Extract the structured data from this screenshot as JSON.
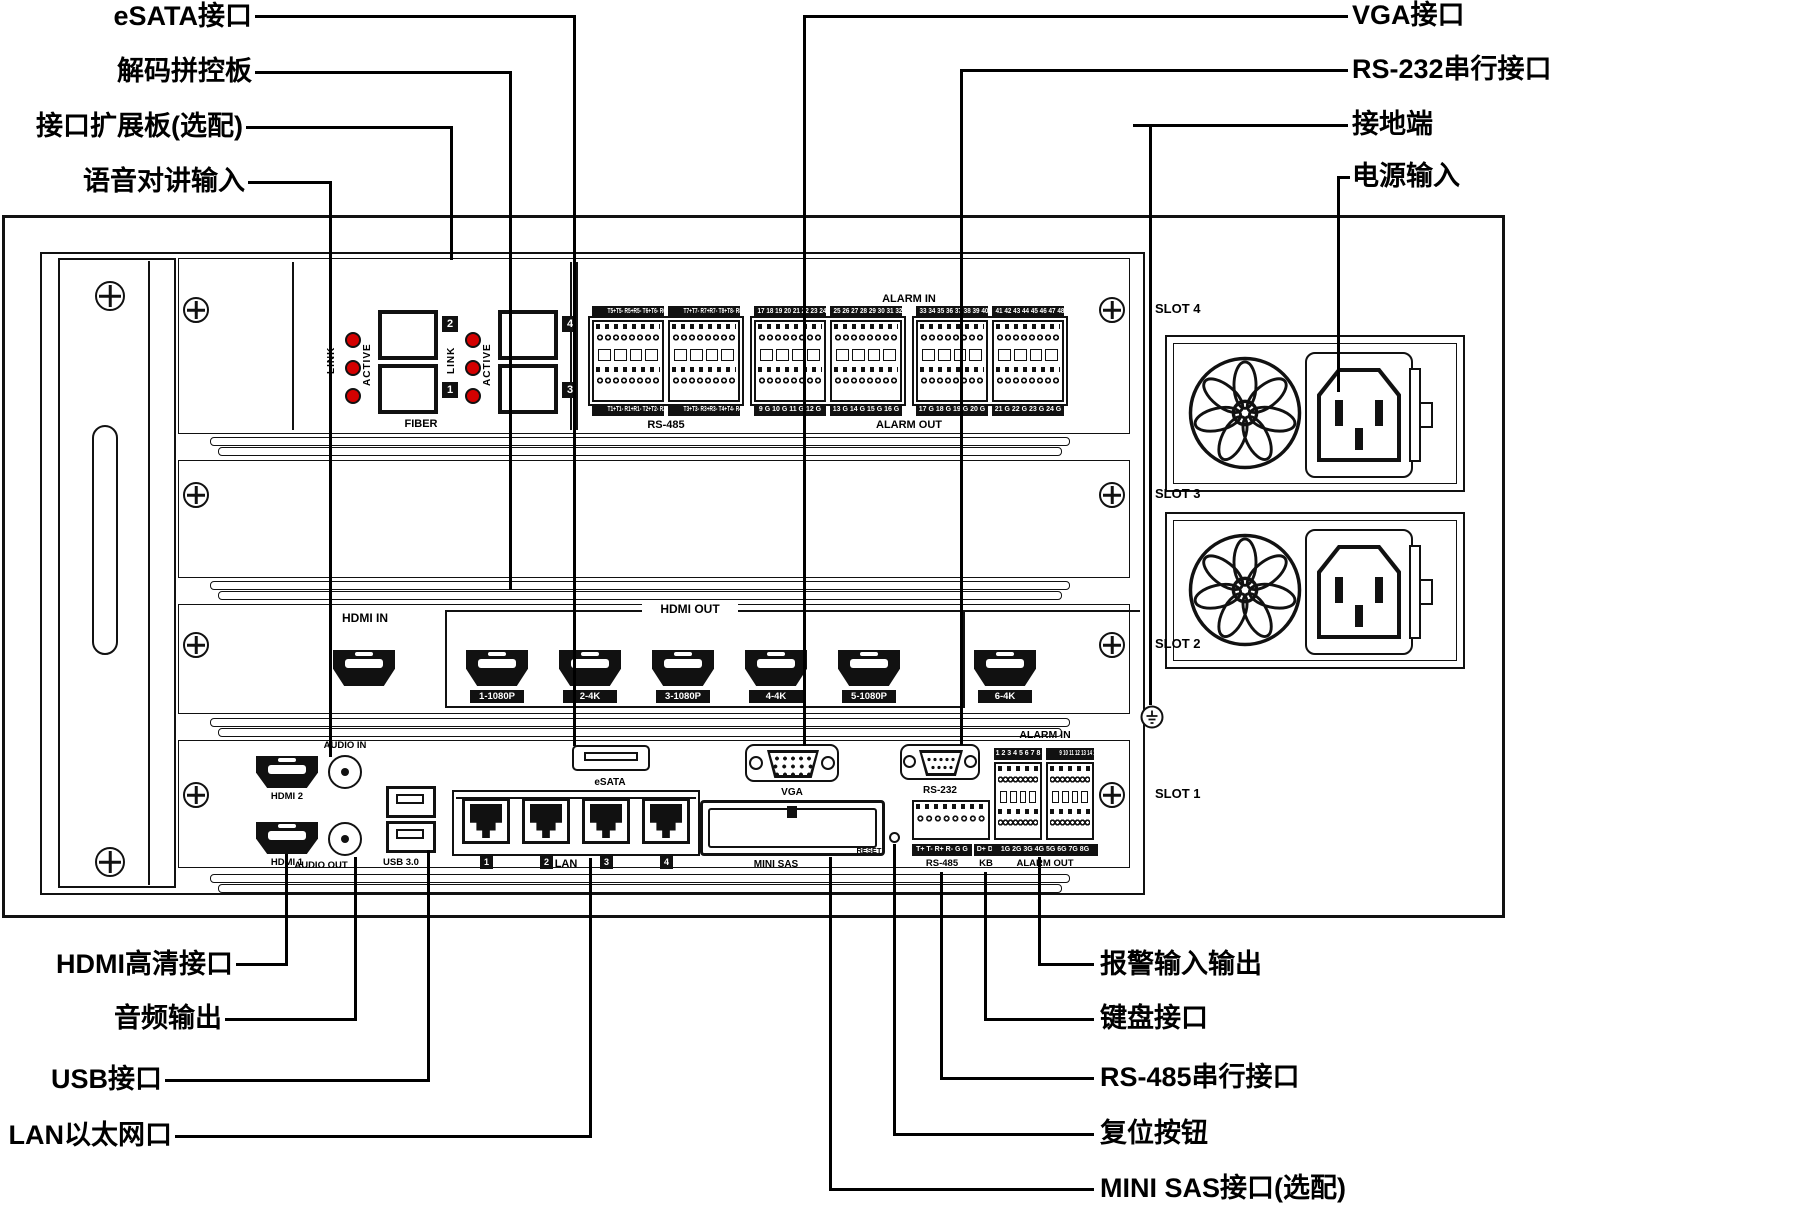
{
  "colors": {
    "line": "#000000",
    "led": "#d40000",
    "panel": "#ffffff",
    "ink": "#111111"
  },
  "slots": [
    "SLOT 4",
    "SLOT 3",
    "SLOT 2",
    "SLOT 1"
  ],
  "callouts": {
    "esata_port": "eSATA接口",
    "decode_board": "解码拼控板",
    "expansion_board": "接口扩展板(选配)",
    "audio_talk_in": "语音对讲输入",
    "vga_port": "VGA接口",
    "rs232_port": "RS-232串行接口",
    "ground_terminal": "接地端",
    "power_input": "电源输入",
    "hdmi_hd_port": "HDMI高清接口",
    "audio_out": "音频输出",
    "usb_port": "USB接口",
    "lan_port": "LAN以太网口",
    "alarm_io": "报警输入输出",
    "keyboard_port": "键盘接口",
    "rs485_port": "RS-485串行接口",
    "reset_button": "复位按钮",
    "mini_sas": "MINI SAS接口(选配)"
  },
  "expansion": {
    "link": "LINK",
    "active": "ACTIVE",
    "fiber": "FIBER",
    "module_numbers": [
      "2",
      "1",
      "4",
      "3"
    ],
    "rs485": {
      "label": "RS-485",
      "top_strips": [
        "T5+T5- R5+R5- T6+T6- R6+R6-",
        "T7+T7- R7+R7- T8+T8- R8+R8-"
      ],
      "bottom_strips": [
        "T1+T1- R1+R1- T2+T2- R2+R2-",
        "T3+T3- R3+R3- T4+T4- R4+R4-"
      ]
    },
    "alarm_in": {
      "header": "ALARM IN",
      "strips": [
        "17 18 19 20 21 22 23 24",
        "25 26 27 28 29 30 31 32",
        "33 34 35 36 37 38 39 40",
        "41 42 43 44 45 46 47 48"
      ]
    },
    "alarm_out": {
      "label": "ALARM OUT",
      "strips": [
        "9 G 10 G 11 G 12 G",
        "13 G 14 G 15 G 16 G",
        "17 G 18 G 19 G 20 G",
        "21 G 22 G 23 G 24 G"
      ]
    }
  },
  "decode": {
    "hdmi_in": "HDMI IN",
    "hdmi_out": "HDMI OUT",
    "out_port_labels": [
      "1-1080P",
      "2-4K",
      "3-1080P",
      "4-4K",
      "5-1080P",
      "6-4K"
    ]
  },
  "main": {
    "audio_in": "AUDIO IN",
    "audio_out": "AUDIO OUT",
    "hdmi2": "HDMI 2",
    "hdmi1": "HDMI 1",
    "usb": "USB 3.0",
    "lan": "LAN",
    "lan_numbers": [
      "1",
      "2",
      "3",
      "4"
    ],
    "esata": "eSATA",
    "vga": "VGA",
    "rs232": "RS-232",
    "mini_sas": "MINI SAS",
    "reset": "RESET",
    "rs485": {
      "strip": "T+ T- R+ R- G G",
      "label": "RS-485"
    },
    "kb": {
      "strip": "D+ D-",
      "label": "KB"
    },
    "alarm_in": {
      "header": "ALARM IN",
      "strips": [
        "1 2 3 4 5 6 7 8",
        "9 10 11 12 13 14 15 16"
      ]
    },
    "alarm_out": {
      "strip": "1G 2G 3G 4G 5G 6G 7G 8G",
      "label": "ALARM OUT"
    }
  }
}
